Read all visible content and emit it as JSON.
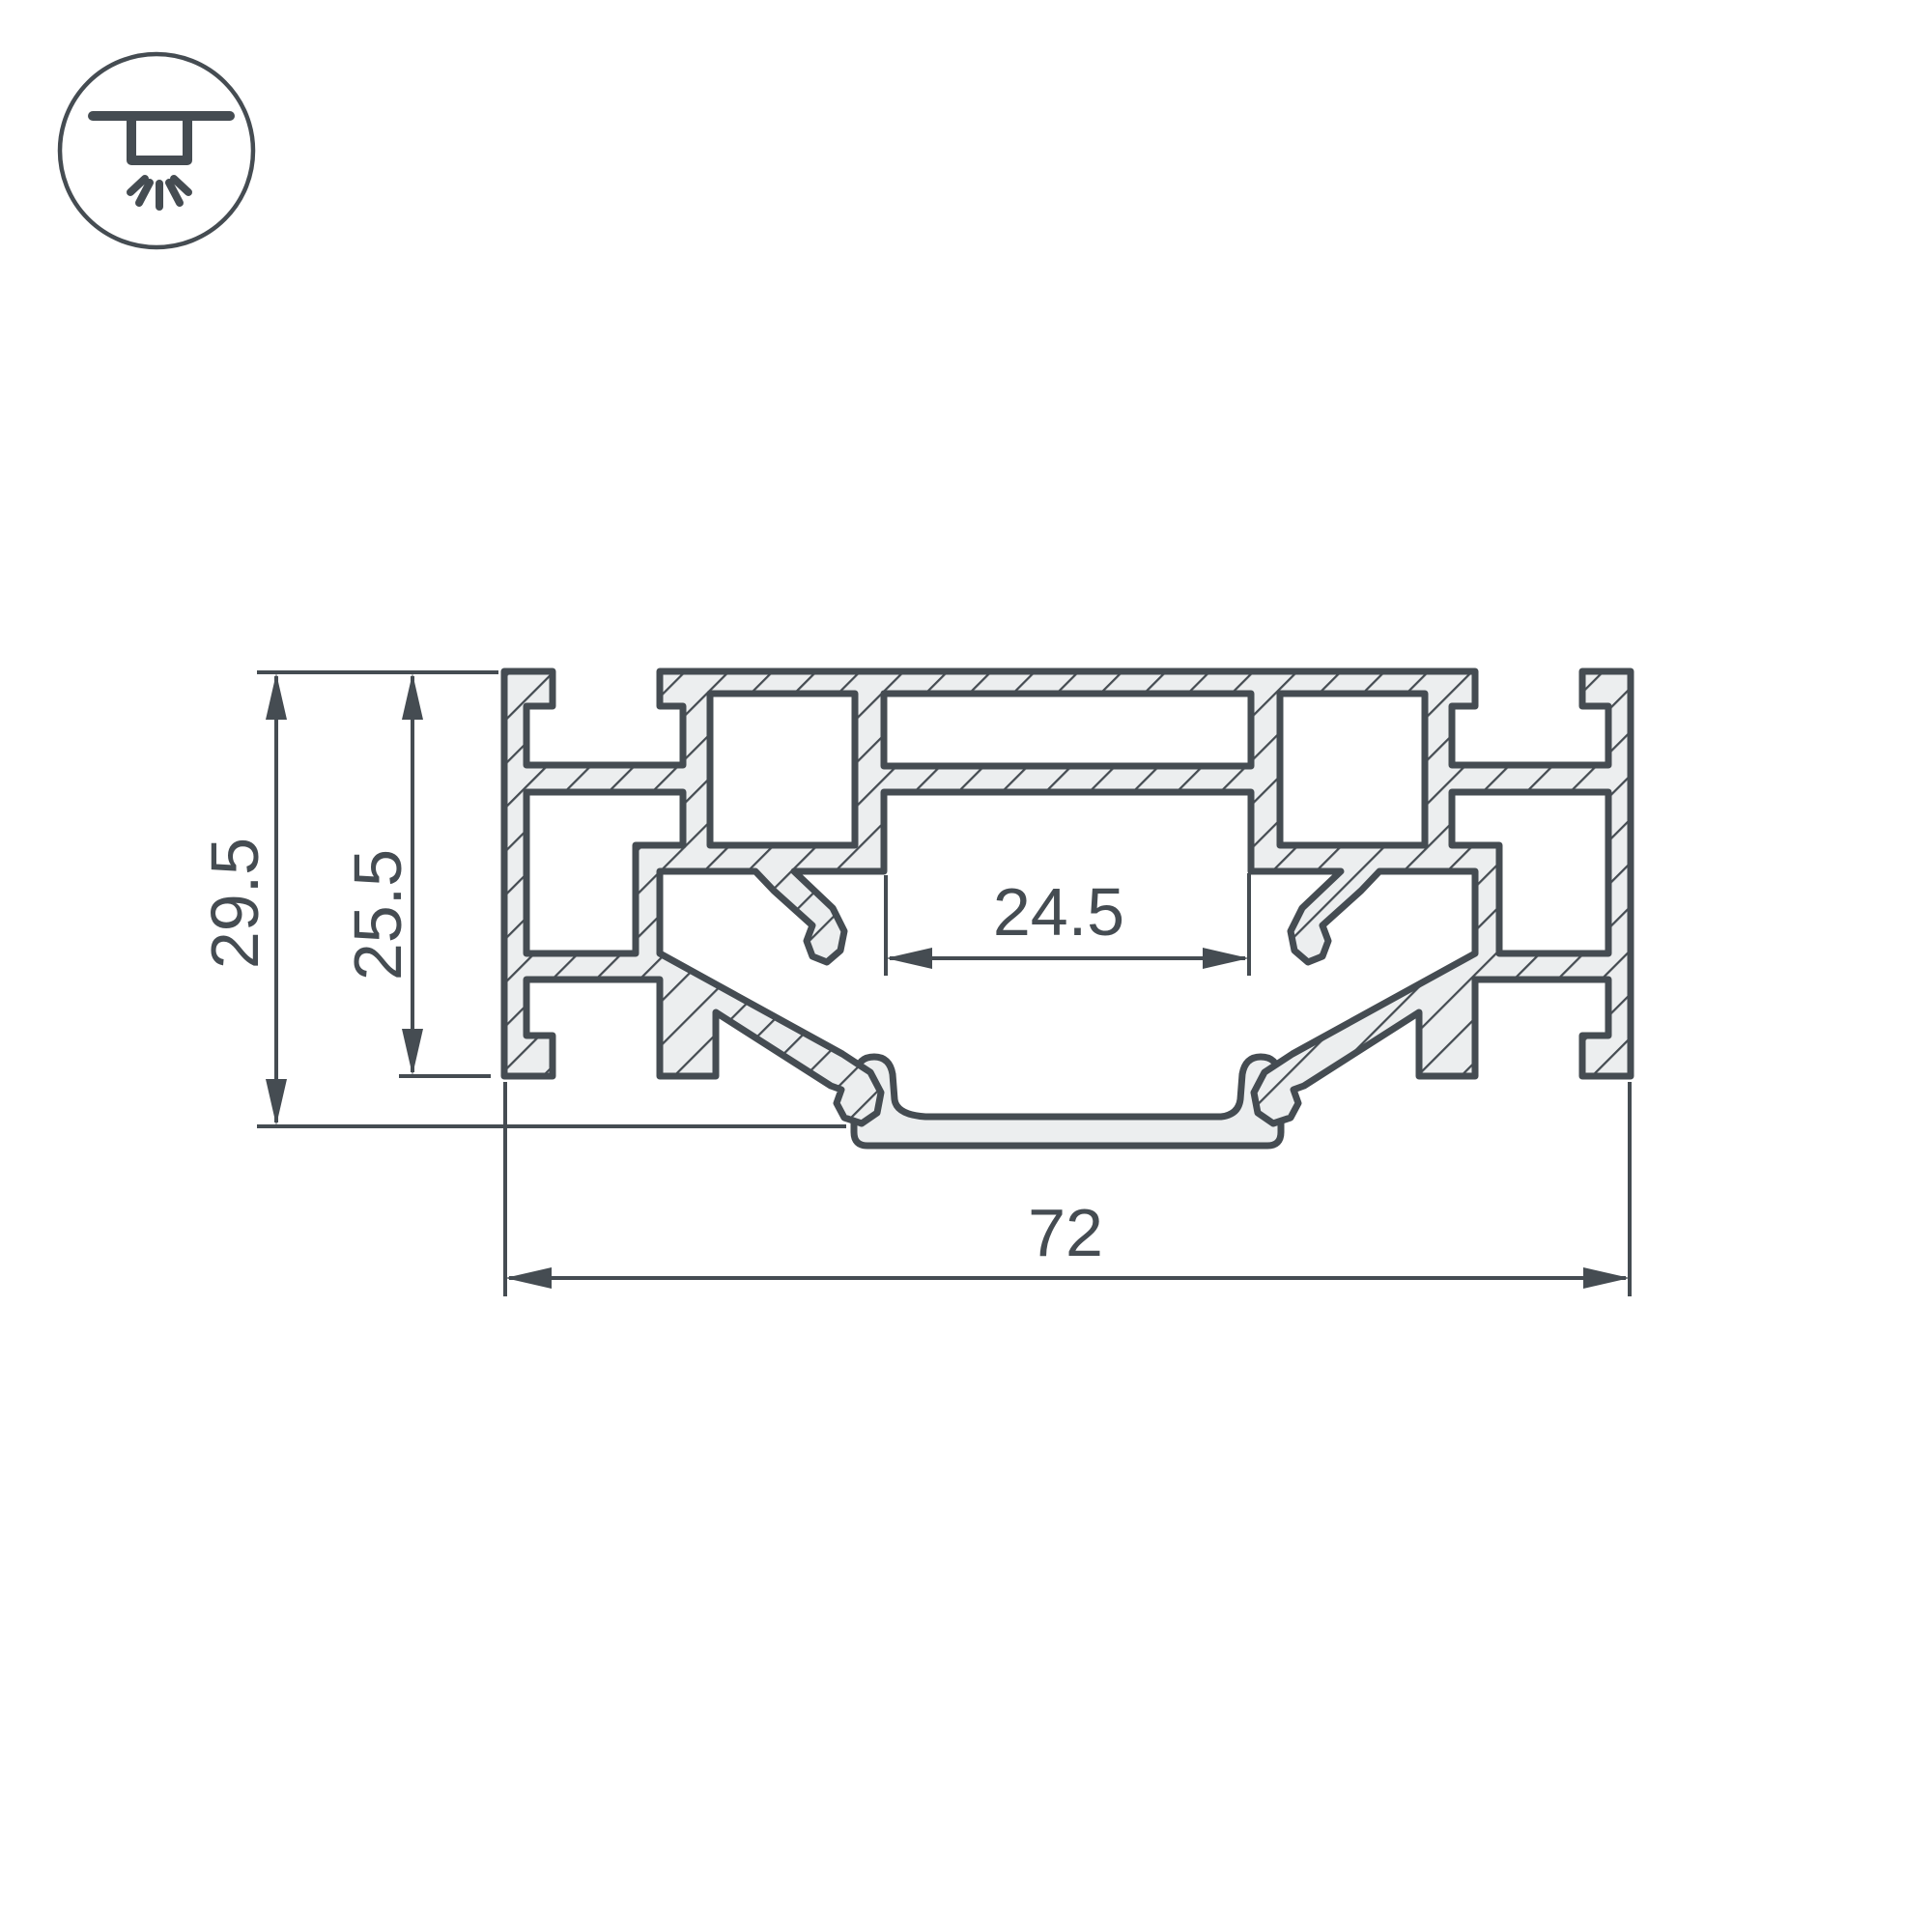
{
  "drawing": {
    "type": "profile-cross-section",
    "icon": {
      "name": "recessed-ceiling-light-icon"
    }
  },
  "colors": {
    "ink": "#454C52",
    "metal_fill": "#ECEEEF",
    "background": "#FFFFFF"
  },
  "dimensions": {
    "height_total": {
      "label": "29.5",
      "value": 29.5
    },
    "height_body": {
      "label": "25.5",
      "value": 25.5
    },
    "opening_width": {
      "label": "24.5",
      "value": 24.5
    },
    "width_total": {
      "label": "72",
      "value": 72
    }
  }
}
